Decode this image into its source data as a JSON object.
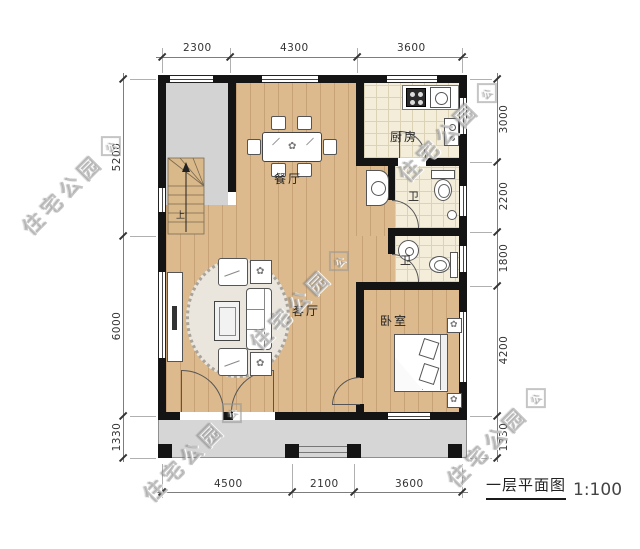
{
  "title": {
    "name": "一层平面图",
    "scale": "1:100"
  },
  "watermark": {
    "text": "住宅公园",
    "logo_char": "公"
  },
  "rooms": {
    "dining": "餐厅",
    "kitchen": "厨房",
    "bath1": "卫",
    "bath2": "卫",
    "living": "客厅",
    "bedroom": "卧室",
    "stair_up": "上"
  },
  "dimensions": {
    "top": [
      "2300",
      "4300",
      "3600"
    ],
    "bottom": [
      "4500",
      "2100",
      "3600"
    ],
    "left": [
      "5200",
      "6000",
      "1330"
    ],
    "right": [
      "3000",
      "2200",
      "1800",
      "4200",
      "1330"
    ]
  },
  "colors": {
    "wall": "#141414",
    "wood_floor": "#dcba8e",
    "tile_floor": "#f3edda",
    "gray_floor": "#d3d3d3",
    "dimension_line": "#7d7d7d",
    "watermark": "#9b9b9b"
  }
}
